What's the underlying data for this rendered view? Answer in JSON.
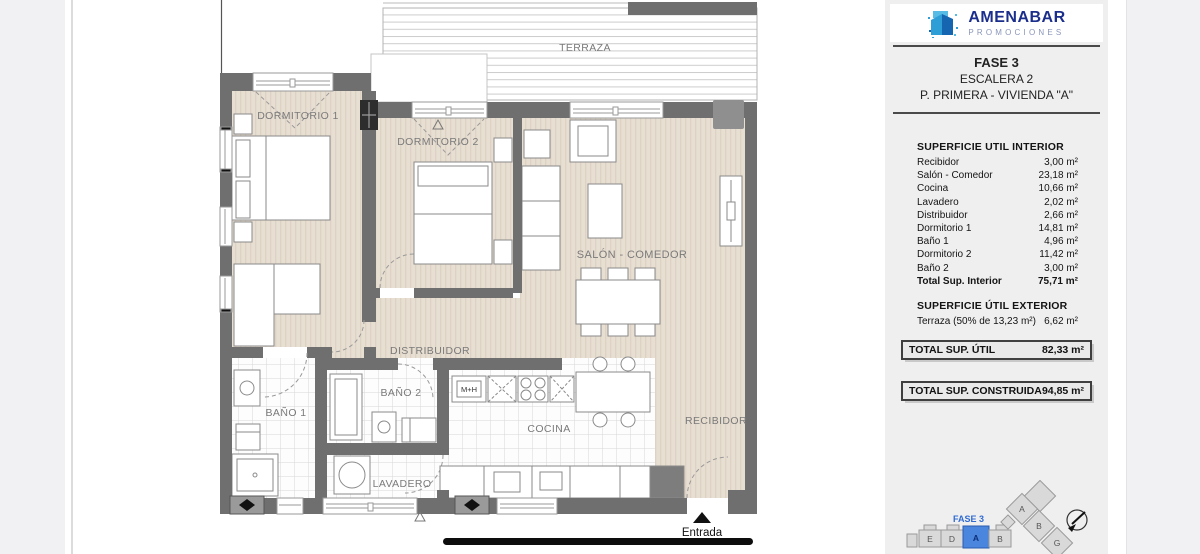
{
  "floorplan": {
    "labels": {
      "terraza": "TERRAZA",
      "dormitorio1": "DORMITORIO 1",
      "dormitorio2": "DORMITORIO 2",
      "salon": "SALÓN - COMEDOR",
      "distribuidor": "DISTRIBUIDOR",
      "bano1": "BAÑO 1",
      "bano2": "BAÑO 2",
      "lavadero": "LAVADERO",
      "cocina": "COCINA",
      "recibidor": "RECIBIDOR",
      "entrada": "Entrada",
      "oven_unit": "M+H"
    },
    "colors": {
      "wall": "#6f6f6f",
      "wood_floor": "#e8dfd3",
      "tile_line": "#d8d8d8"
    }
  },
  "sidebar": {
    "brand": {
      "name": "AMENABAR",
      "tagline": "PROMOCIONES",
      "name_color": "#1c2e8c",
      "tagline_color": "#8a95ba"
    },
    "title": {
      "line1": "FASE 3",
      "line2": "ESCALERA 2",
      "line3": "P. PRIMERA - VIVIENDA \"A\""
    },
    "interior": {
      "header": "SUPERFICIE UTIL INTERIOR",
      "rows": [
        {
          "label": "Recibidor",
          "value": "3,00 m²"
        },
        {
          "label": "Salón - Comedor",
          "value": "23,18 m²"
        },
        {
          "label": "Cocina",
          "value": "10,66 m²"
        },
        {
          "label": "Lavadero",
          "value": "2,02 m²"
        },
        {
          "label": "Distribuidor",
          "value": "2,66 m²"
        },
        {
          "label": "Dormitorio 1",
          "value": "14,81 m²"
        },
        {
          "label": "Baño 1",
          "value": "4,96 m²"
        },
        {
          "label": "Dormitorio 2",
          "value": "11,42 m²"
        },
        {
          "label": "Baño 2",
          "value": "3,00 m²"
        }
      ],
      "total": {
        "label": "Total Sup. Interior",
        "value": "75,71 m²"
      }
    },
    "exterior": {
      "header": "SUPERFICIE ÚTIL EXTERIOR",
      "rows": [
        {
          "label": "Terraza (50% de 13,23 m²)",
          "value": "6,62 m²"
        }
      ]
    },
    "totals": [
      {
        "label": "TOTAL SUP. ÚTIL",
        "value": "82,33 m²"
      },
      {
        "label": "TOTAL SUP. CONSTRUIDA",
        "value": "94,85 m²"
      }
    ],
    "siteplan": {
      "fase": "FASE 3",
      "fase_color": "#2f6bd0",
      "row_blocks": [
        "E",
        "D",
        "A",
        "B"
      ],
      "highlighted": "A",
      "highlight_color": "#4a86dd",
      "wing_blocks": [
        "A",
        "B",
        "G"
      ]
    }
  }
}
